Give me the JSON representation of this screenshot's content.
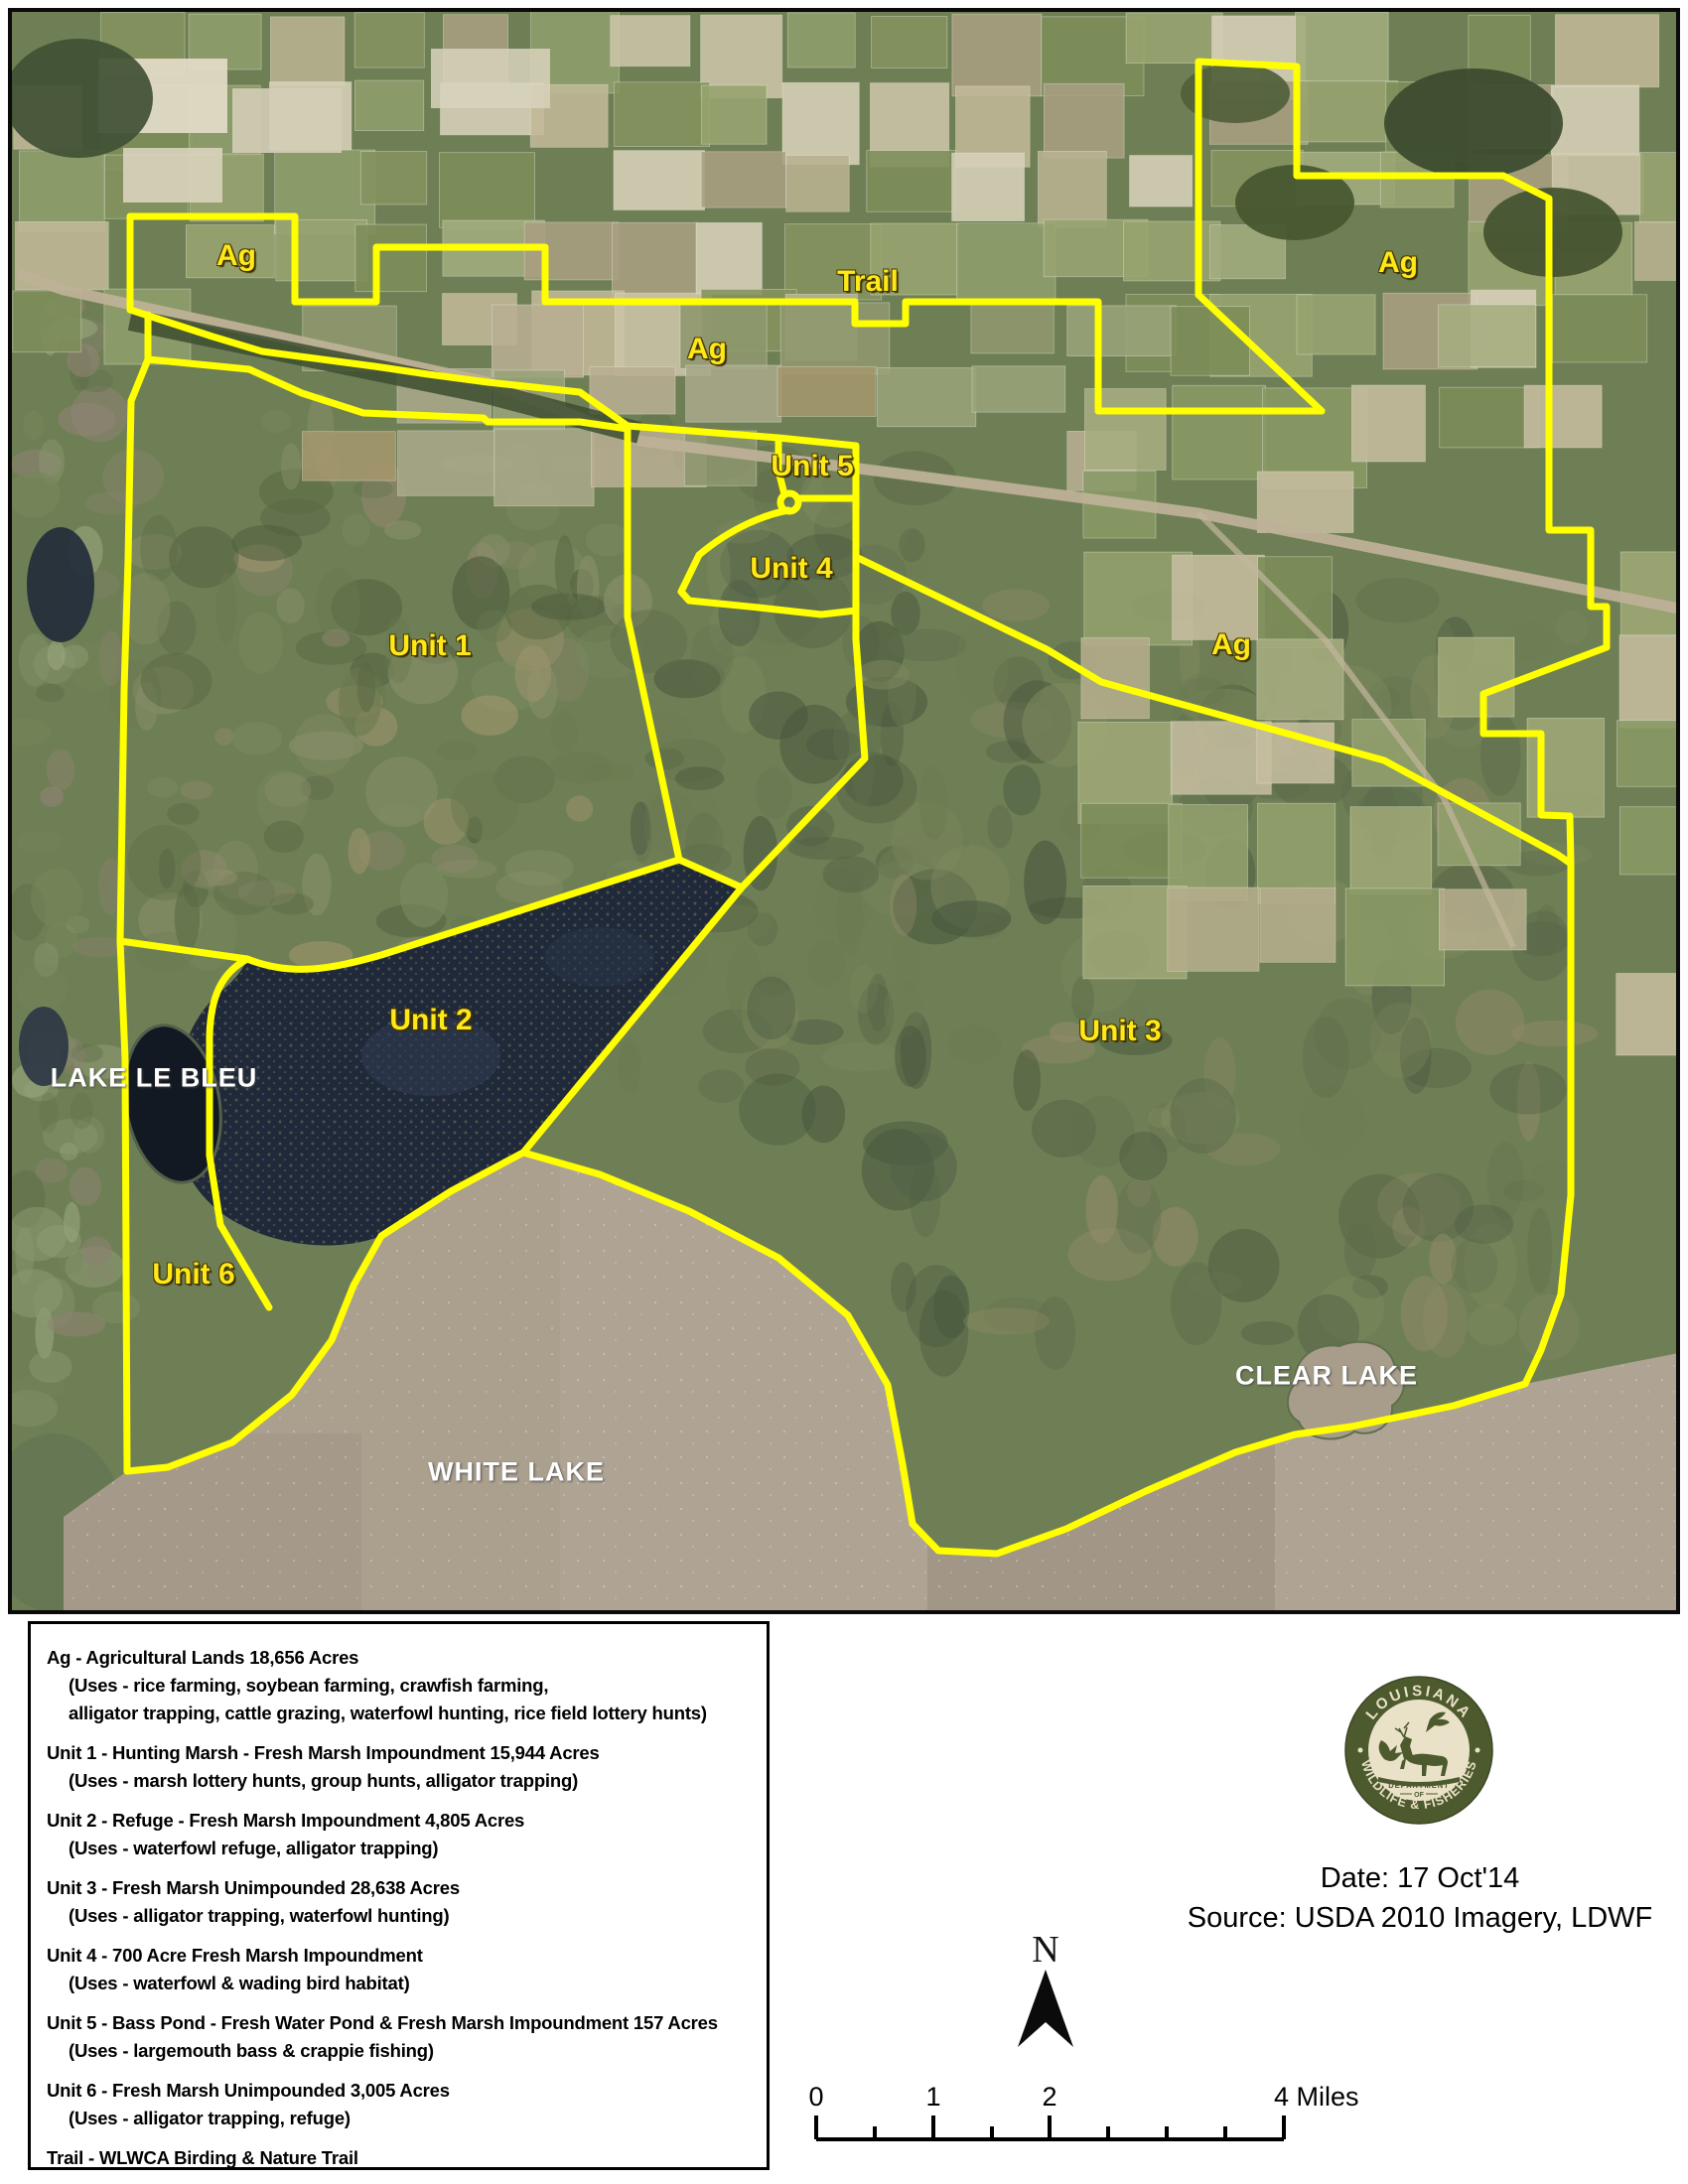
{
  "map": {
    "labels": {
      "ag_topleft": "Ag",
      "ag_central": "Ag",
      "ag_topright": "Ag",
      "ag_right": "Ag",
      "trail": "Trail",
      "unit1": "Unit 1",
      "unit2": "Unit 2",
      "unit3": "Unit 3",
      "unit4": "Unit 4",
      "unit5": "Unit 5",
      "unit6": "Unit 6",
      "lake_le_bleu": "LAKE LE BLEU",
      "white_lake": "WHITE LAKE",
      "clear_lake": "CLEAR LAKE"
    },
    "colors": {
      "boundary": "#ffff00",
      "label_yellow": "#ffe819",
      "water": "#ab9f8e"
    }
  },
  "legend": {
    "entries": [
      {
        "lines": [
          "Ag - Agricultural Lands 18,656 Acres",
          "(Uses - rice farming, soybean farming, crawfish farming,",
          "alligator trapping, cattle grazing, waterfowl hunting, rice field lottery hunts)"
        ]
      },
      {
        "lines": [
          "Unit 1 - Hunting Marsh - Fresh Marsh Impoundment 15,944 Acres",
          "(Uses - marsh lottery hunts, group hunts, alligator trapping)"
        ]
      },
      {
        "lines": [
          "Unit 2 - Refuge - Fresh Marsh Impoundment 4,805 Acres",
          "(Uses - waterfowl refuge, alligator trapping)"
        ]
      },
      {
        "lines": [
          "Unit 3 - Fresh Marsh Unimpounded 28,638 Acres",
          "(Uses - alligator trapping, waterfowl hunting)"
        ]
      },
      {
        "lines": [
          "Unit 4 - 700 Acre Fresh Marsh Impoundment",
          "(Uses - waterfowl & wading bird habitat)"
        ]
      },
      {
        "lines": [
          "Unit 5 - Bass Pond - Fresh Water Pond & Fresh Marsh Impoundment 157 Acres",
          "(Uses - largemouth bass & crappie fishing)"
        ]
      },
      {
        "lines": [
          "Unit 6 - Fresh Marsh Unimpounded 3,005 Acres",
          "(Uses - alligator trapping, refuge)"
        ]
      },
      {
        "lines": [
          "Trail - WLWCA Birding & Nature Trail"
        ]
      }
    ]
  },
  "logo": {
    "arc_top": "LOUISIANA",
    "arc_bottom": "WILDLIFE & FISHERIES",
    "dept_line1": "DEPARTMENT",
    "dept_line2": "OF",
    "ring_color": "#4d5a2e",
    "cream_color": "#eae2c8"
  },
  "info": {
    "date_line": "Date: 17 Oct'14",
    "source_line": "Source: USDA 2010 Imagery, LDWF"
  },
  "compass": {
    "label": "N"
  },
  "scalebar": {
    "tick_labels": [
      "0",
      "1",
      "2"
    ],
    "end_label": "4 Miles"
  }
}
